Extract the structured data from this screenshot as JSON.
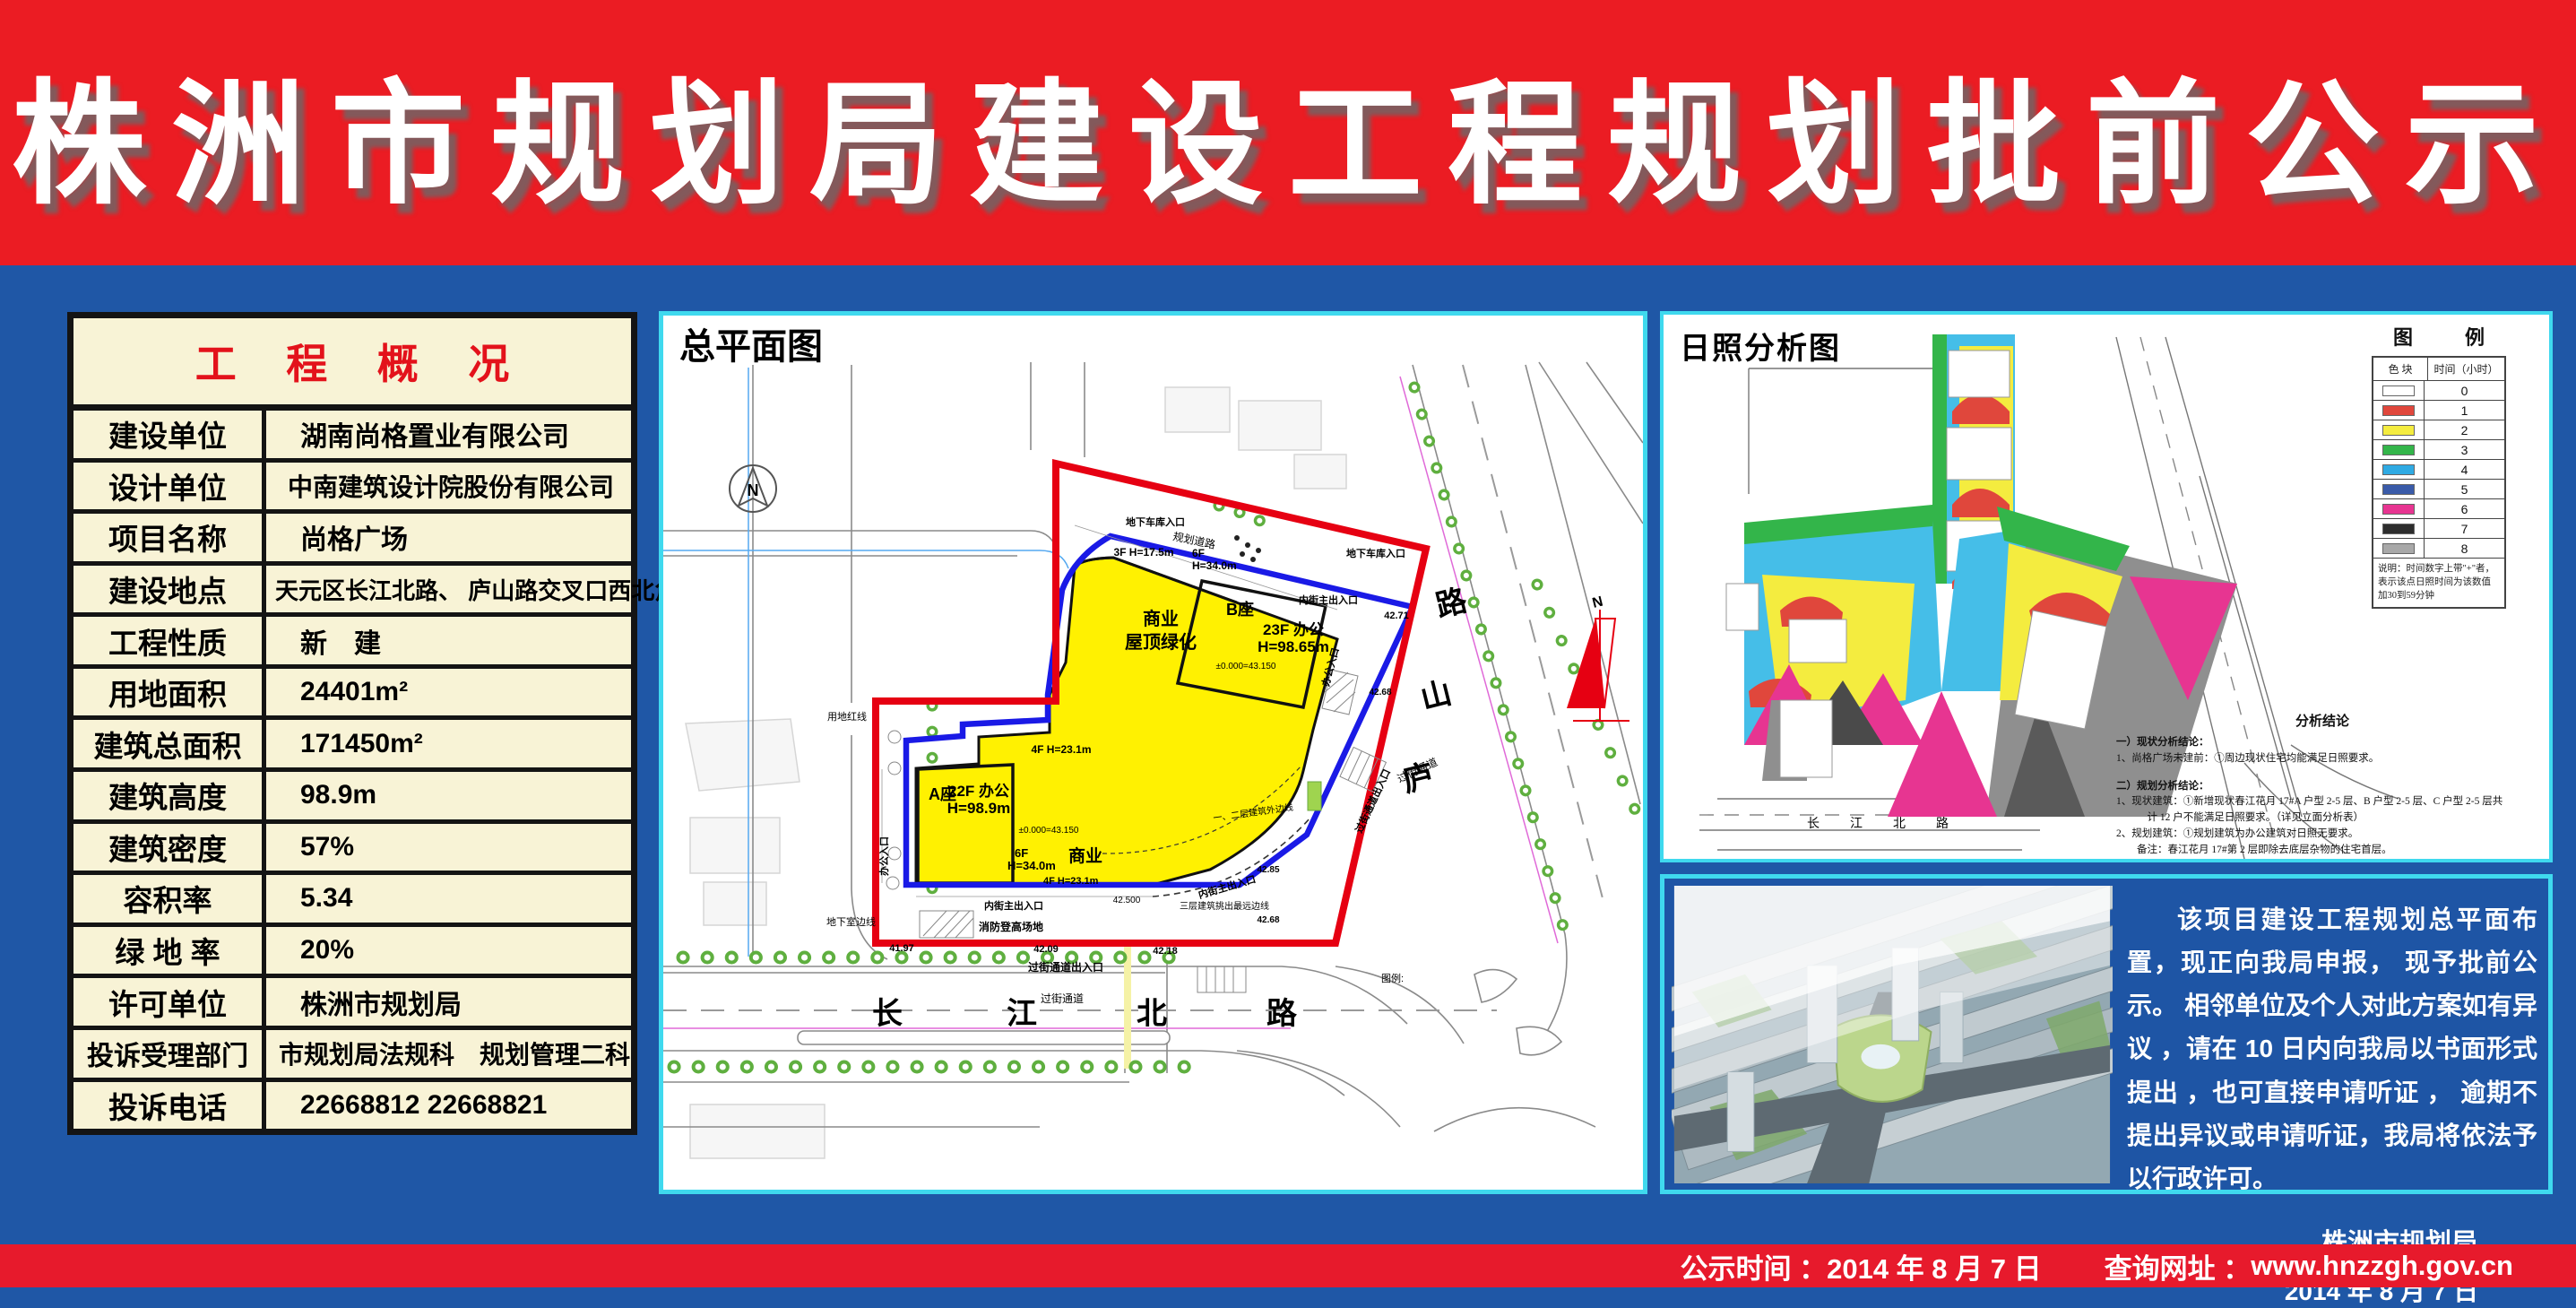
{
  "banner": {
    "title": "株洲市规划局建设工程规划批前公示"
  },
  "project_table": {
    "title": "工 程 概 况",
    "rows": [
      {
        "label": "建设单位",
        "value": "湖南尚格置业有限公司"
      },
      {
        "label": "设计单位",
        "value": "中南建筑设计院股份有限公司"
      },
      {
        "label": "项目名称",
        "value": "尚格广场"
      },
      {
        "label": "建设地点",
        "value": "天元区长江北路、 庐山路交叉口西北角"
      },
      {
        "label": "工程性质",
        "value": "新　建"
      },
      {
        "label": "用地面积",
        "value": "24401m²"
      },
      {
        "label": "建筑总面积",
        "value": "171450m²"
      },
      {
        "label": "建筑高度",
        "value": "98.9m"
      },
      {
        "label": "建筑密度",
        "value": "57%"
      },
      {
        "label": "容积率",
        "value": "5.34"
      },
      {
        "label": "绿 地 率",
        "value": "20%"
      },
      {
        "label": "许可单位",
        "value": "株洲市规划局"
      },
      {
        "label": "投诉受理部门",
        "value": "市规划局法规科　规划管理二科"
      },
      {
        "label": "投诉电话",
        "value": "22668812  22668821"
      }
    ]
  },
  "site_plan": {
    "title": "总平面图",
    "labels": {
      "commercial_top": "商业",
      "roof_green": "屋顶绿化",
      "block_b": "B座",
      "b_use": "23F 办公",
      "b_height": "H=98.65m",
      "podium_3f": "3F H=17.5m",
      "podium_6f": "6F",
      "podium_6f_h": "H=34.0m",
      "block_a": "A座",
      "a_use": "22F 办公",
      "a_height": "H=98.9m",
      "level_b": "±0.000=43.150",
      "level_a": "±0.000=43.150",
      "f4_mid": "4F H=23.1m",
      "f6_low": "6F",
      "f6_low_h": "H=34.0m",
      "commercial_low": "商业",
      "f4_low": "4F H=23.1m",
      "fire_area": "消防登高场地",
      "inner_entry_top": "内街主出入口",
      "inner_entry_b1": "内街主出入口",
      "inner_entry_b2": "内街主出入口",
      "garage_entry_left": "地下车库入口",
      "garage_entry_right": "地下车库入口",
      "office_entry_left": "办公入口",
      "office_entry_right": "办公入口",
      "basement_line": "地下室边线",
      "red_line": "用地红线",
      "planning_road": "规划道路",
      "f3_overhang": "三层建筑挑出最远边线",
      "f12_outline": "一、二层建筑外边线",
      "crossing_exit_bottom": "过街通道出入口",
      "crossing_exit_right": "过街通道出入口",
      "crossing_bottom": "过街通道",
      "crossing_right": "过街通道",
      "lv41_97": "41.97",
      "lv42_09": "42.09",
      "lv42_18": "42.18",
      "lv42_500": "42.500",
      "lv42_68a": "42.68",
      "lv42_85": "42.85",
      "lv42_71": "42.71",
      "lv42_68b": "42.68",
      "cjb_1": "长",
      "cjb_2": "江",
      "cjb_3": "北",
      "cjb_4": "路",
      "ls_1": "路",
      "ls_2": "山",
      "ls_3": "庐",
      "legend_ref": "图例:",
      "north": "N"
    }
  },
  "sunlight": {
    "title": "日照分析图",
    "legend_title": "图　例",
    "legend_headers": [
      "色 块",
      "时间（小时）"
    ],
    "legend_rows": [
      {
        "color": "#FFFFFF",
        "hours": "0"
      },
      {
        "color": "#E0473C",
        "hours": "1"
      },
      {
        "color": "#F4EC3F",
        "hours": "2"
      },
      {
        "color": "#33B54A",
        "hours": "3"
      },
      {
        "color": "#2FAAE3",
        "hours": "4"
      },
      {
        "color": "#3A5BA9",
        "hours": "5"
      },
      {
        "color": "#E73591",
        "hours": "6"
      },
      {
        "color": "#2D2D2D",
        "hours": "7"
      },
      {
        "color": "#A8A8A8",
        "hours": "8"
      }
    ],
    "legend_note": "说明：时间数字上带\"+\"者，表示该点日照时间为该数值加30到59分钟",
    "road_label": "长　江　北　路",
    "conclusion_title": "分析结论",
    "conclusion_lines": [
      "一）现状分析结论：",
      "1、尚格广场未建前：①周边现状住宅均能满足日照要求。",
      "",
      "二）规划分析结论：",
      "1、现状建筑：①新增现状春江花月 17#A 户型 2-5 层、B 户型 2-5 层、C 户型 2-5 层共",
      "　　　计 12 户不能满足日照要求。（详见立面分析表）",
      "2、规划建筑：①规划建筑为办公建筑对日照无要求。",
      "　　备注：春江花月 17#第 2 层即除去底层杂物的住宅首层。"
    ]
  },
  "notice": {
    "paragraph": "该项目建设工程规划总平面布置，现正向我局申报， 现予批前公示。 相邻单位及个人对此方案如有异议 ，请在 10 日内向我局以书面形式提出 ，也可直接申请听证 ， 逾期不提出异议或申请听证，我局将依法予以行政许可。",
    "signature": "株洲市规划局",
    "date": "2014 年 8 月 7 日"
  },
  "footer": {
    "time_label": "公示时间 ：",
    "time_value": "2014 年 8 月 7 日",
    "url_label": "查询网址 ：",
    "url_value": "www.hnzzgh.gov.cn"
  }
}
